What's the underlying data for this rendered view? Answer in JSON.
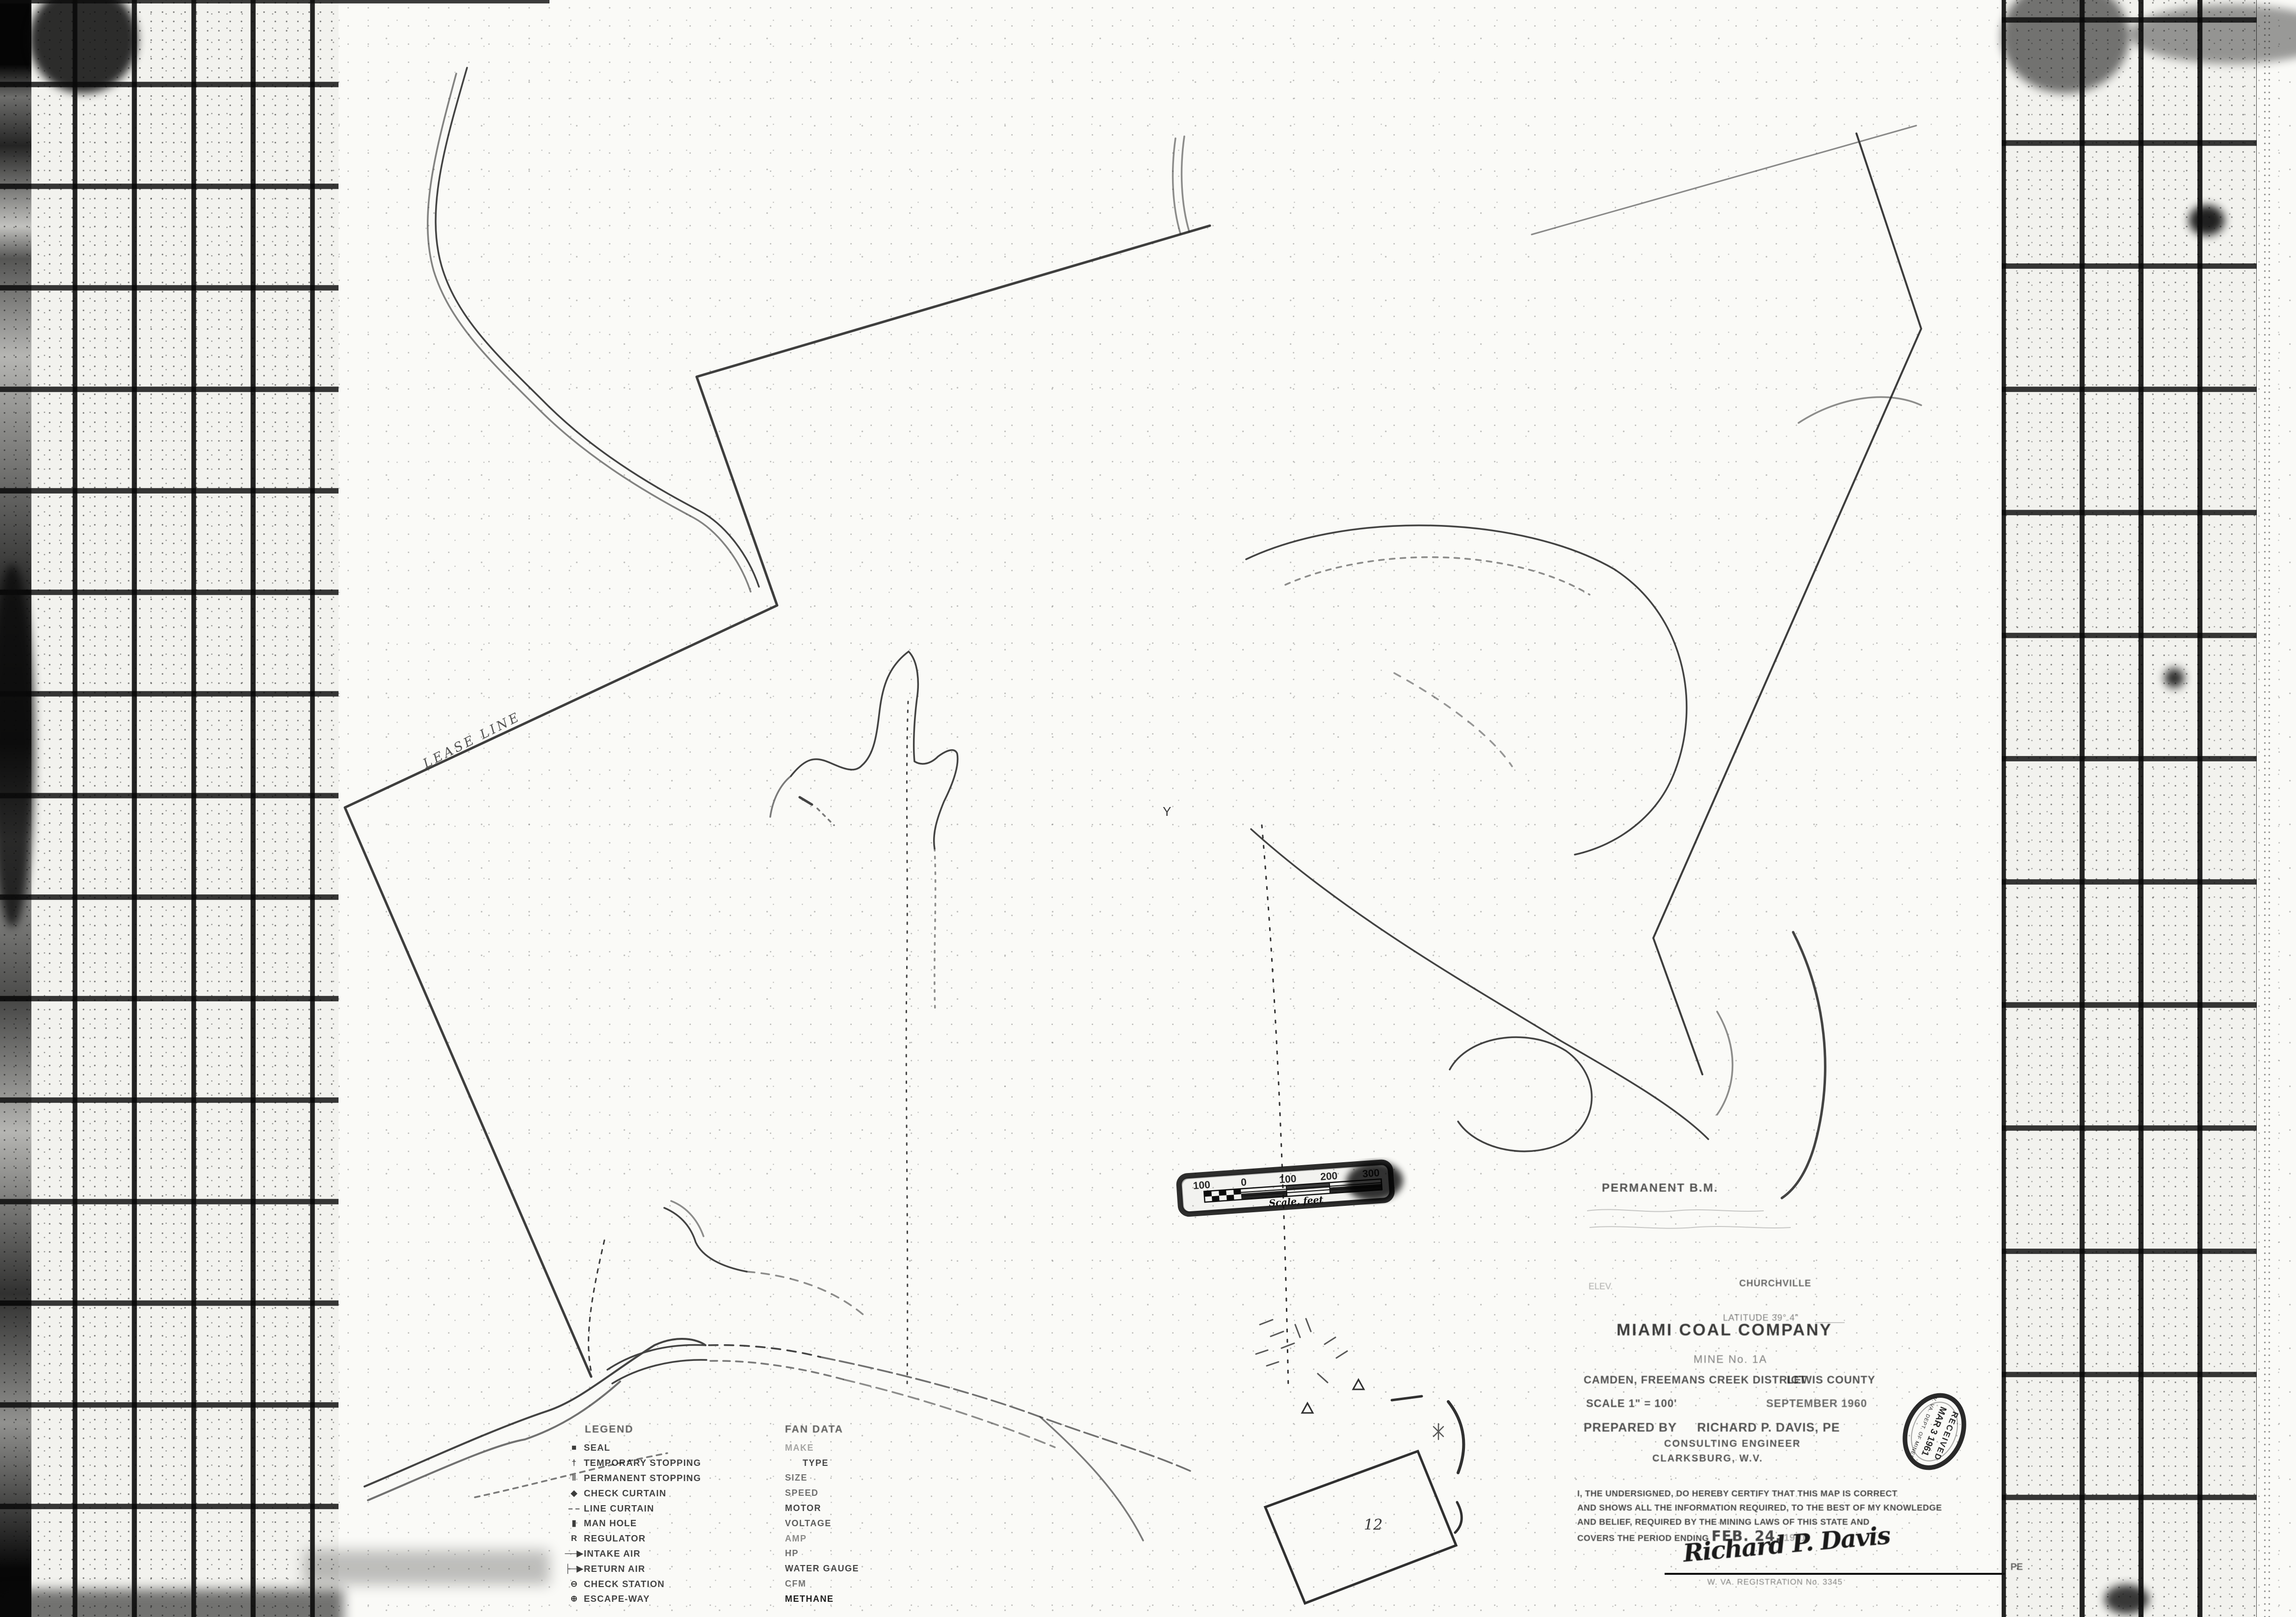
{
  "title_block": {
    "company": "MIAMI COAL COMPANY",
    "mine": "MINE No. 1A",
    "district": "CAMDEN, FREEMANS CREEK DISTRICT",
    "county": "LEWIS COUNTY",
    "scale": "SCALE   1\" = 100'",
    "date": "SEPTEMBER 1960",
    "prepared_label": "PREPARED BY",
    "engineer": "RICHARD P. DAVIS, PE",
    "engineer_title": "CONSULTING ENGINEER",
    "engineer_city": "CLARKSBURG, W.V."
  },
  "survey_notes": {
    "permanent_bm": "PERMANENT  B.M.",
    "elev": "ELEV.",
    "benchmark_ref": "CHURCHVILLE",
    "latitude": "LATITUDE    39°.4\""
  },
  "certification": {
    "lines": [
      "I, THE UNDERSIGNED, DO HEREBY CERTIFY THAT THIS MAP IS CORRECT",
      "AND SHOWS ALL THE INFORMATION REQUIRED, TO THE BEST OF MY KNOWLEDGE",
      "AND BELIEF, REQUIRED BY THE MINING LAWS OF THIS STATE AND",
      "COVERS THE PERIOD ENDING"
    ],
    "period_date": "FEB. 24,",
    "period_year": "1961",
    "signature": "Richard P. Davis",
    "signature_suffix": "PE",
    "registration": "W. VA. REGISTRATION No. 3345"
  },
  "stamp": {
    "received": "RECEIVED",
    "date": "MAR 3 1961",
    "agency": "W. VA. DEPT. OF MINES"
  },
  "scale_bar": {
    "ticks": [
      "100",
      "0",
      "100",
      "200",
      "300"
    ],
    "caption": "Scale, feet"
  },
  "legend": {
    "title": "LEGEND",
    "items": [
      {
        "symbol": "■",
        "label": "SEAL"
      },
      {
        "symbol": "†",
        "label": "TEMPORARY STOPPING"
      },
      {
        "symbol": "‖",
        "label": "PERMANENT STOPPING"
      },
      {
        "symbol": "◆",
        "label": "CHECK CURTAIN"
      },
      {
        "symbol": "– –",
        "label": "LINE CURTAIN"
      },
      {
        "symbol": "▮",
        "label": "MAN HOLE"
      },
      {
        "symbol": "R",
        "label": "REGULATOR"
      },
      {
        "symbol": "──▶",
        "label": "INTAKE AIR"
      },
      {
        "symbol": "├─▶",
        "label": "RETURN AIR"
      },
      {
        "symbol": "⊖",
        "label": "CHECK STATION"
      },
      {
        "symbol": "⊕",
        "label": "ESCAPE-WAY"
      }
    ]
  },
  "fan_data": {
    "title": "FAN DATA",
    "fields": [
      "MAKE",
      "TYPE",
      "SIZE",
      "SPEED",
      "MOTOR",
      "VOLTAGE",
      "AMP",
      "HP",
      "WATER GAUGE",
      "CFM",
      "METHANE"
    ]
  },
  "map_labels": {
    "lease_line": "LEASE LINE",
    "y_marker": "Y",
    "number_12": "12"
  }
}
